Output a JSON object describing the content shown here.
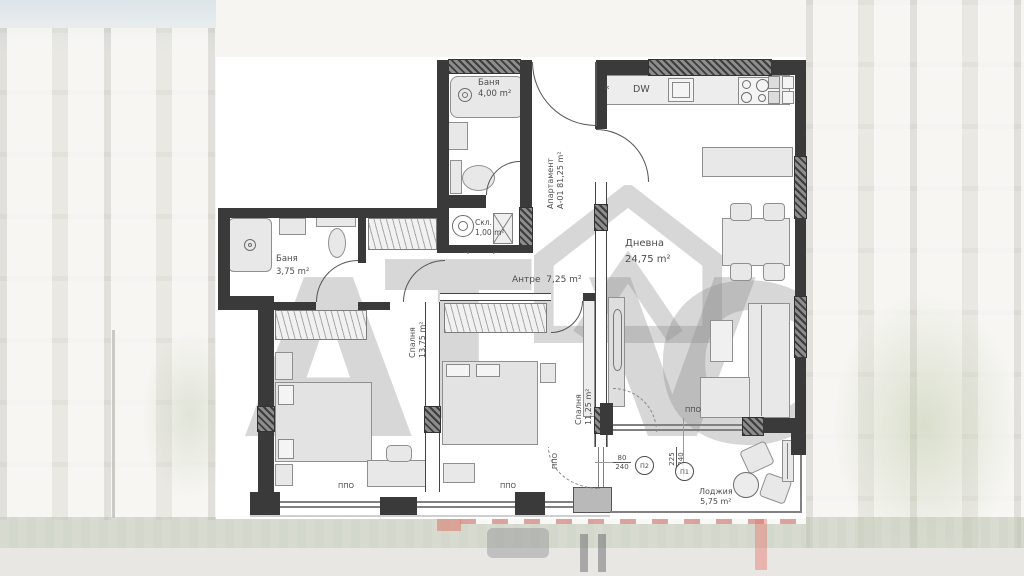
{
  "watermark": {
    "a": "А",
    "t": "Т",
    "v": "V",
    "c": "С"
  },
  "apartment_label": {
    "line1": "Апартамент",
    "line2": "А-01 81,25 m²"
  },
  "rooms": {
    "bath1": {
      "name": "Баня",
      "area": "4,00 m²"
    },
    "bath2": {
      "name": "Баня",
      "area": "3,75 m²"
    },
    "storage": {
      "name": "Скл.",
      "area": "1,00 m²"
    },
    "hall": {
      "name": "Антре",
      "area": "7,25 m²"
    },
    "living": {
      "name": "Дневна",
      "area": "24,75 m²"
    },
    "bedroom1": {
      "name": "Спалня",
      "area": "13,75 m²"
    },
    "bedroom2": {
      "name": "Спалня",
      "area": "11,25 m²"
    },
    "loggia": {
      "name": "Лоджия",
      "area": "5,75 m²"
    }
  },
  "kitchen": {
    "dw": "DW",
    "star": "*"
  },
  "hall_arrows": {
    "right": "→",
    "left": "←"
  },
  "markers": {
    "ppo": "ППО",
    "p1": "П1",
    "p2": "П2",
    "d1_num": "80",
    "d1_den": "240",
    "d2_num": "225",
    "d2_den": "240"
  }
}
